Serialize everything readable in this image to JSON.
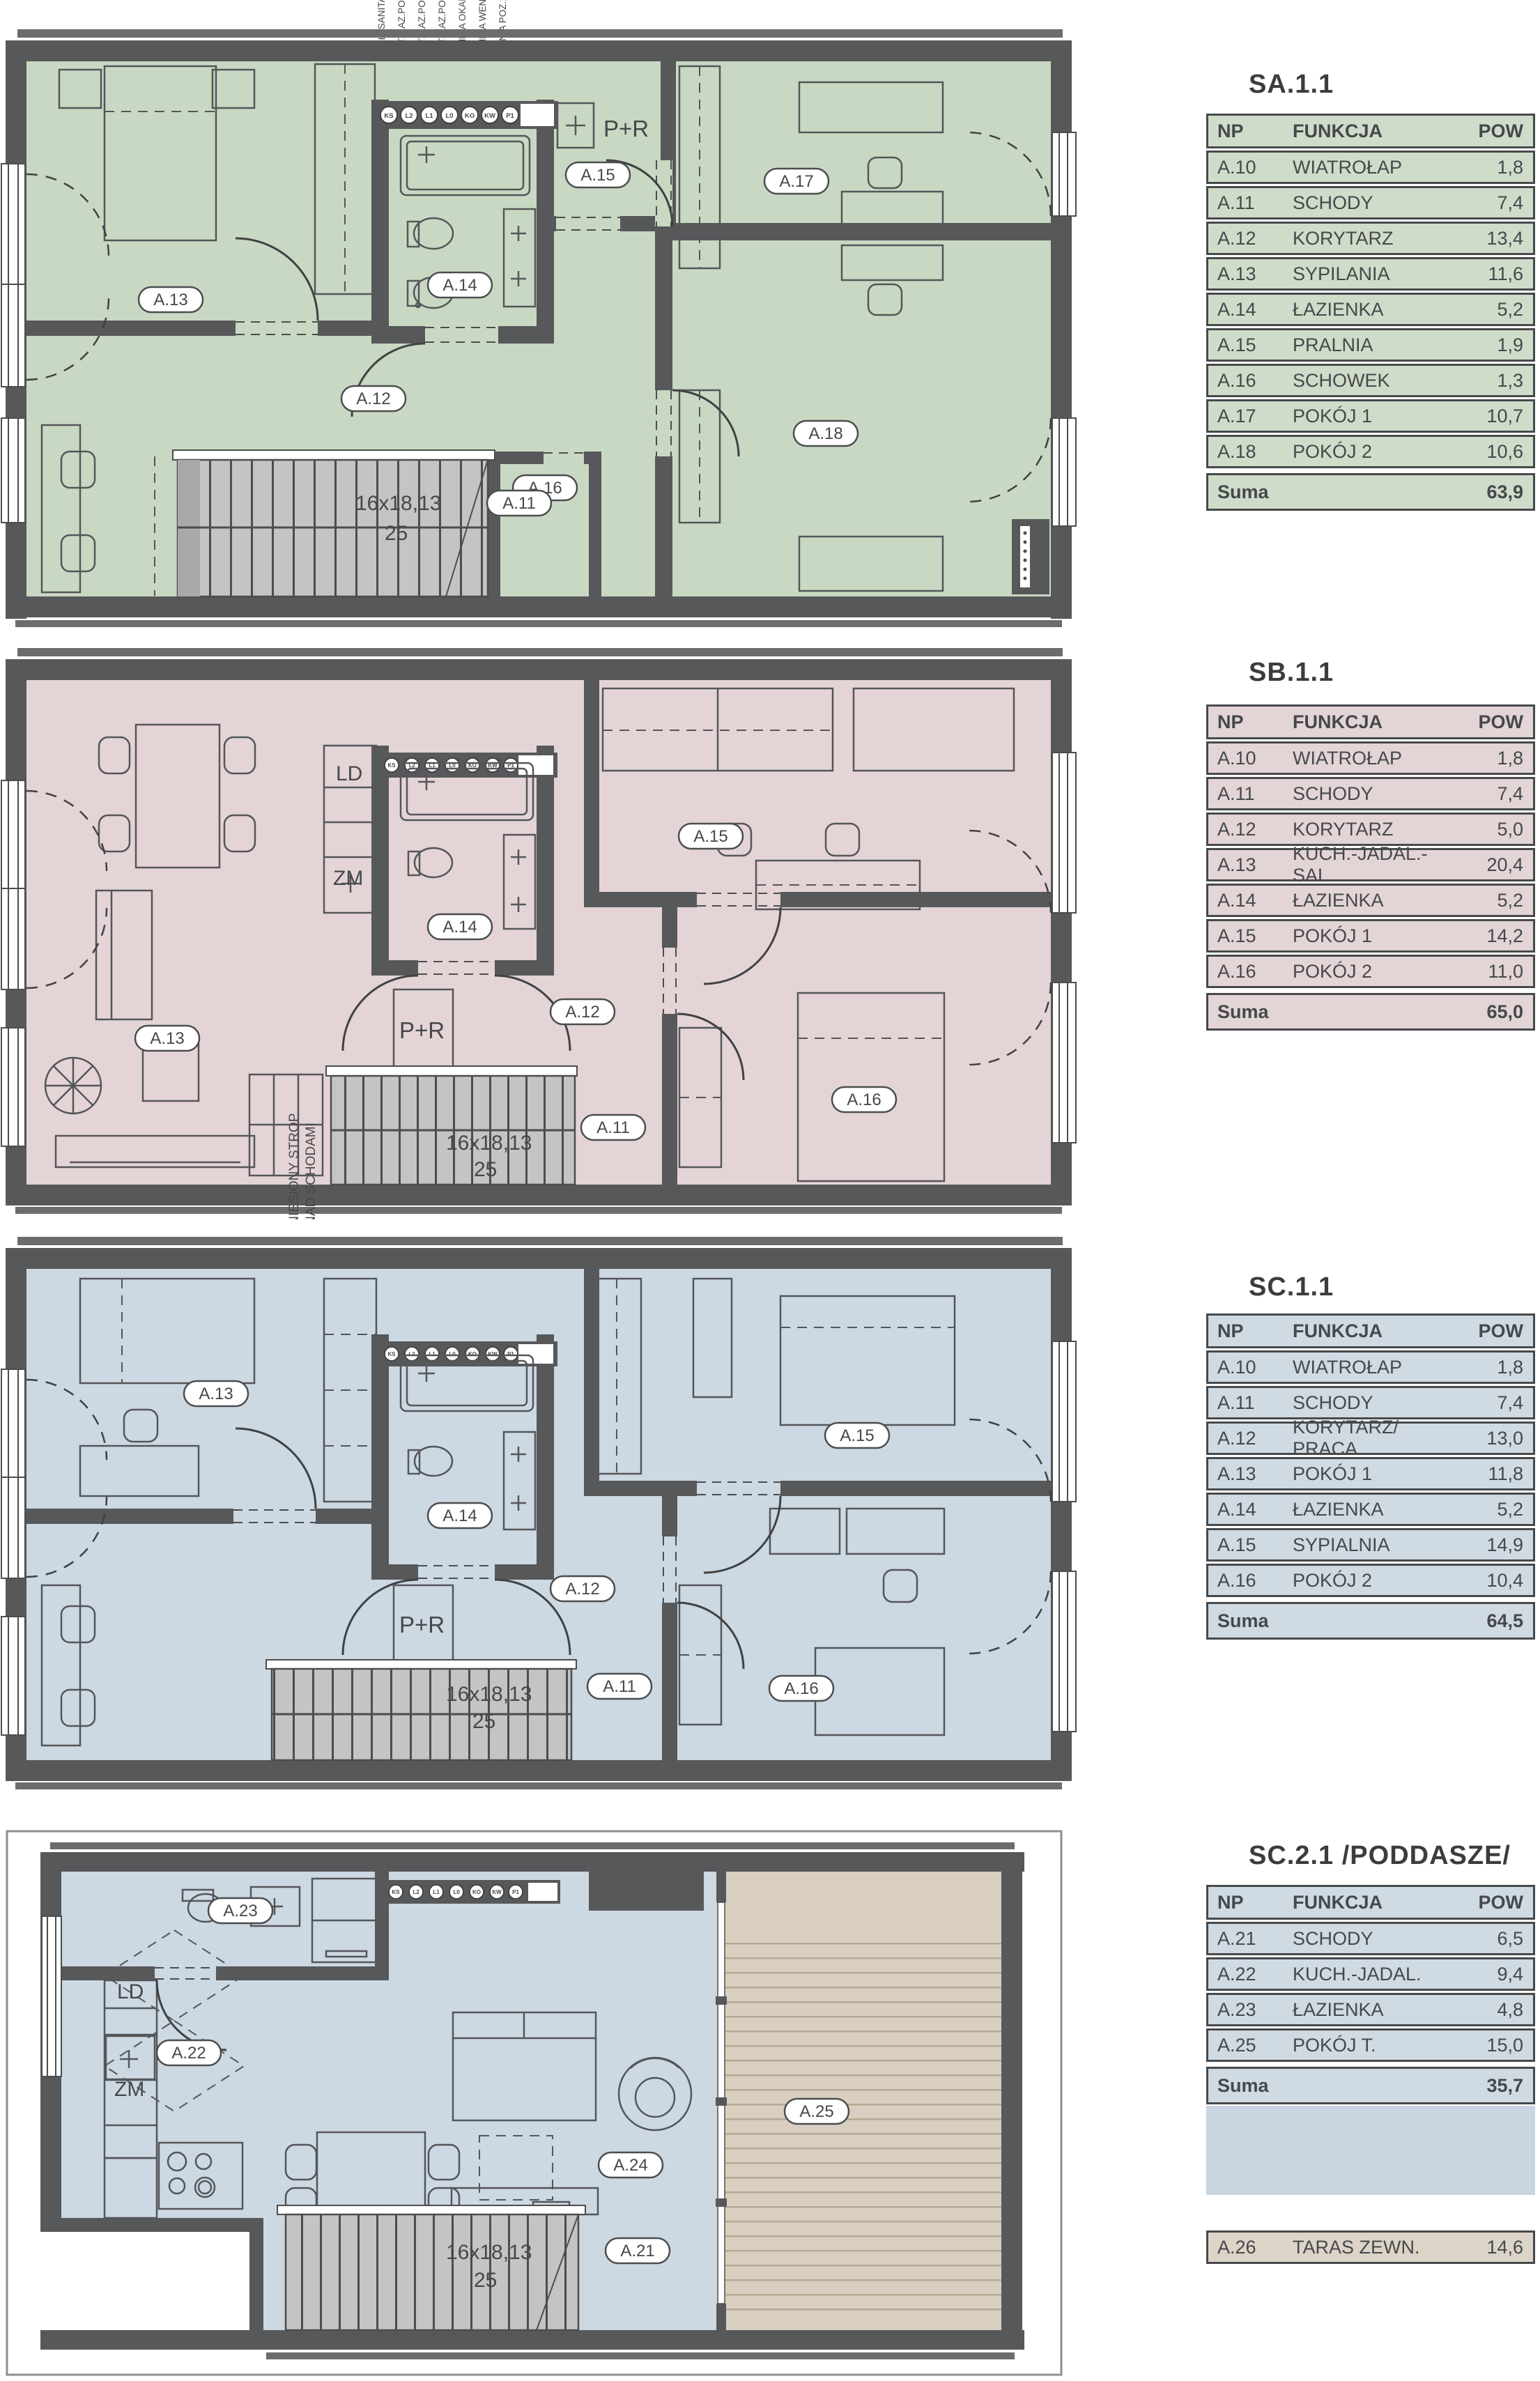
{
  "colors": {
    "wall": "#57585a",
    "wall_cap": "#6a6c6e",
    "line": "#4b4d4f",
    "floor_green": "#c9d8c2",
    "floor_pink": "#e4d4d6",
    "floor_blue": "#ccd8e2",
    "terrace_beige": "#d9cfc0",
    "stair_gray": "#c4c4c4",
    "table_green": "#cfdcc9",
    "table_pink": "#e3d4d6",
    "table_blue": "#cfdae3",
    "table_beige": "#dcd4c7"
  },
  "plans": [
    {
      "name": "SA.1.1",
      "rooms": [
        "A.13",
        "A.14",
        "A.15",
        "A.17",
        "A.12",
        "A.18",
        "A.16",
        "A.11"
      ],
      "vent_codes": [
        "KS",
        "L2",
        "L1",
        "L0",
        "KO",
        "KW",
        "P1"
      ],
      "vent_labels": [
        "KANAŁ. SANITAR.",
        "WENT. ŁAZ.POZ.2",
        "WENT. ŁAZ.POZ.1",
        "WENT. ŁAZ.POZ.0",
        "KUCHNIA OKAP",
        "KUCHNIA WENT.",
        "PRALNIA POZ.1"
      ],
      "stair": [
        "16x18,13",
        "25"
      ],
      "annotations": {
        "pr": "P+R"
      }
    },
    {
      "name": "SB.1.1",
      "rooms": [
        "A.13",
        "A.14",
        "A.15",
        "A.12",
        "A.16",
        "A.11"
      ],
      "vent_codes": [
        "KS",
        "L2",
        "L1",
        "L0",
        "KO",
        "KW",
        "P1"
      ],
      "stair": [
        "16x18,13",
        "25"
      ],
      "annotations": {
        "ld": "LD",
        "zm": "ZM",
        "pr": "P+R",
        "note1": "UNIESIONY STROP",
        "note2": "NAD SCHODAMI"
      }
    },
    {
      "name": "SC.1.1",
      "rooms": [
        "A.13",
        "A.14",
        "A.15",
        "A.12",
        "A.16",
        "A.11"
      ],
      "vent_codes": [
        "KS",
        "L2",
        "L1",
        "L0",
        "KO",
        "KW",
        "P1"
      ],
      "stair": [
        "16x18,13",
        "25"
      ],
      "annotations": {
        "pr": "P+R"
      }
    },
    {
      "name": "SC.2.1",
      "rooms": [
        "A.23",
        "A.22",
        "A.24",
        "A.25",
        "A.21"
      ],
      "vent_codes": [
        "KS",
        "L2",
        "L1",
        "L0",
        "KO",
        "KW",
        "P1"
      ],
      "stair": [
        "16x18,13",
        "25"
      ],
      "annotations": {
        "ld": "LD",
        "zm": "ZM"
      }
    }
  ],
  "tables": [
    {
      "title": "SA.1.1",
      "color": "#cfdcc9",
      "columns": [
        "NP",
        "FUNKCJA",
        "POW"
      ],
      "rows": [
        [
          "A.10",
          "WIATROŁAP",
          "1,8"
        ],
        [
          "A.11",
          "SCHODY",
          "7,4"
        ],
        [
          "A.12",
          "KORYTARZ",
          "13,4"
        ],
        [
          "A.13",
          "SYPILANIA",
          "11,6"
        ],
        [
          "A.14",
          "ŁAZIENKA",
          "5,2"
        ],
        [
          "A.15",
          "PRALNIA",
          "1,9"
        ],
        [
          "A.16",
          "SCHOWEK",
          "1,3"
        ],
        [
          "A.17",
          "POKÓJ 1",
          "10,7"
        ],
        [
          "A.18",
          "POKÓJ 2",
          "10,6"
        ]
      ],
      "suma_label": "Suma",
      "suma_value": "63,9"
    },
    {
      "title": "SB.1.1",
      "color": "#e3d4d6",
      "columns": [
        "NP",
        "FUNKCJA",
        "POW"
      ],
      "rows": [
        [
          "A.10",
          "WIATROŁAP",
          "1,8"
        ],
        [
          "A.11",
          "SCHODY",
          "7,4"
        ],
        [
          "A.12",
          "KORYTARZ",
          "5,0"
        ],
        [
          "A.13",
          "KUCH.-JADAL.-SAL.",
          "20,4"
        ],
        [
          "A.14",
          "ŁAZIENKA",
          "5,2"
        ],
        [
          "A.15",
          "POKÓJ 1",
          "14,2"
        ],
        [
          "A.16",
          "POKÓJ 2",
          "11,0"
        ]
      ],
      "suma_label": "Suma",
      "suma_value": "65,0"
    },
    {
      "title": "SC.1.1",
      "color": "#cfdae3",
      "columns": [
        "NP",
        "FUNKCJA",
        "POW"
      ],
      "rows": [
        [
          "A.10",
          "WIATROŁAP",
          "1,8"
        ],
        [
          "A.11",
          "SCHODY",
          "7,4"
        ],
        [
          "A.12",
          "KORYTARZ/ PRACA",
          "13,0"
        ],
        [
          "A.13",
          "POKÓJ 1",
          "11,8"
        ],
        [
          "A.14",
          "ŁAZIENKA",
          "5,2"
        ],
        [
          "A.15",
          "SYPIALNIA",
          "14,9"
        ],
        [
          "A.16",
          "POKÓJ 2",
          "10,4"
        ]
      ],
      "suma_label": "Suma",
      "suma_value": "64,5"
    },
    {
      "title": "SC.2.1 /PODDASZE/",
      "color": "#cfdae3",
      "columns": [
        "NP",
        "FUNKCJA",
        "POW"
      ],
      "rows": [
        [
          "A.21",
          "SCHODY",
          "6,5"
        ],
        [
          "A.22",
          "KUCH.-JADAL.",
          "9,4"
        ],
        [
          "A.23",
          "ŁAZIENKA",
          "4,8"
        ],
        [
          "A.25",
          "POKÓJ T.",
          "15,0"
        ]
      ],
      "suma_label": "Suma",
      "suma_value": "35,7"
    },
    {
      "title": null,
      "color": "#dcd4c7",
      "rows": [
        [
          "A.26",
          "TARAS ZEWN.",
          "14,6"
        ]
      ]
    }
  ]
}
